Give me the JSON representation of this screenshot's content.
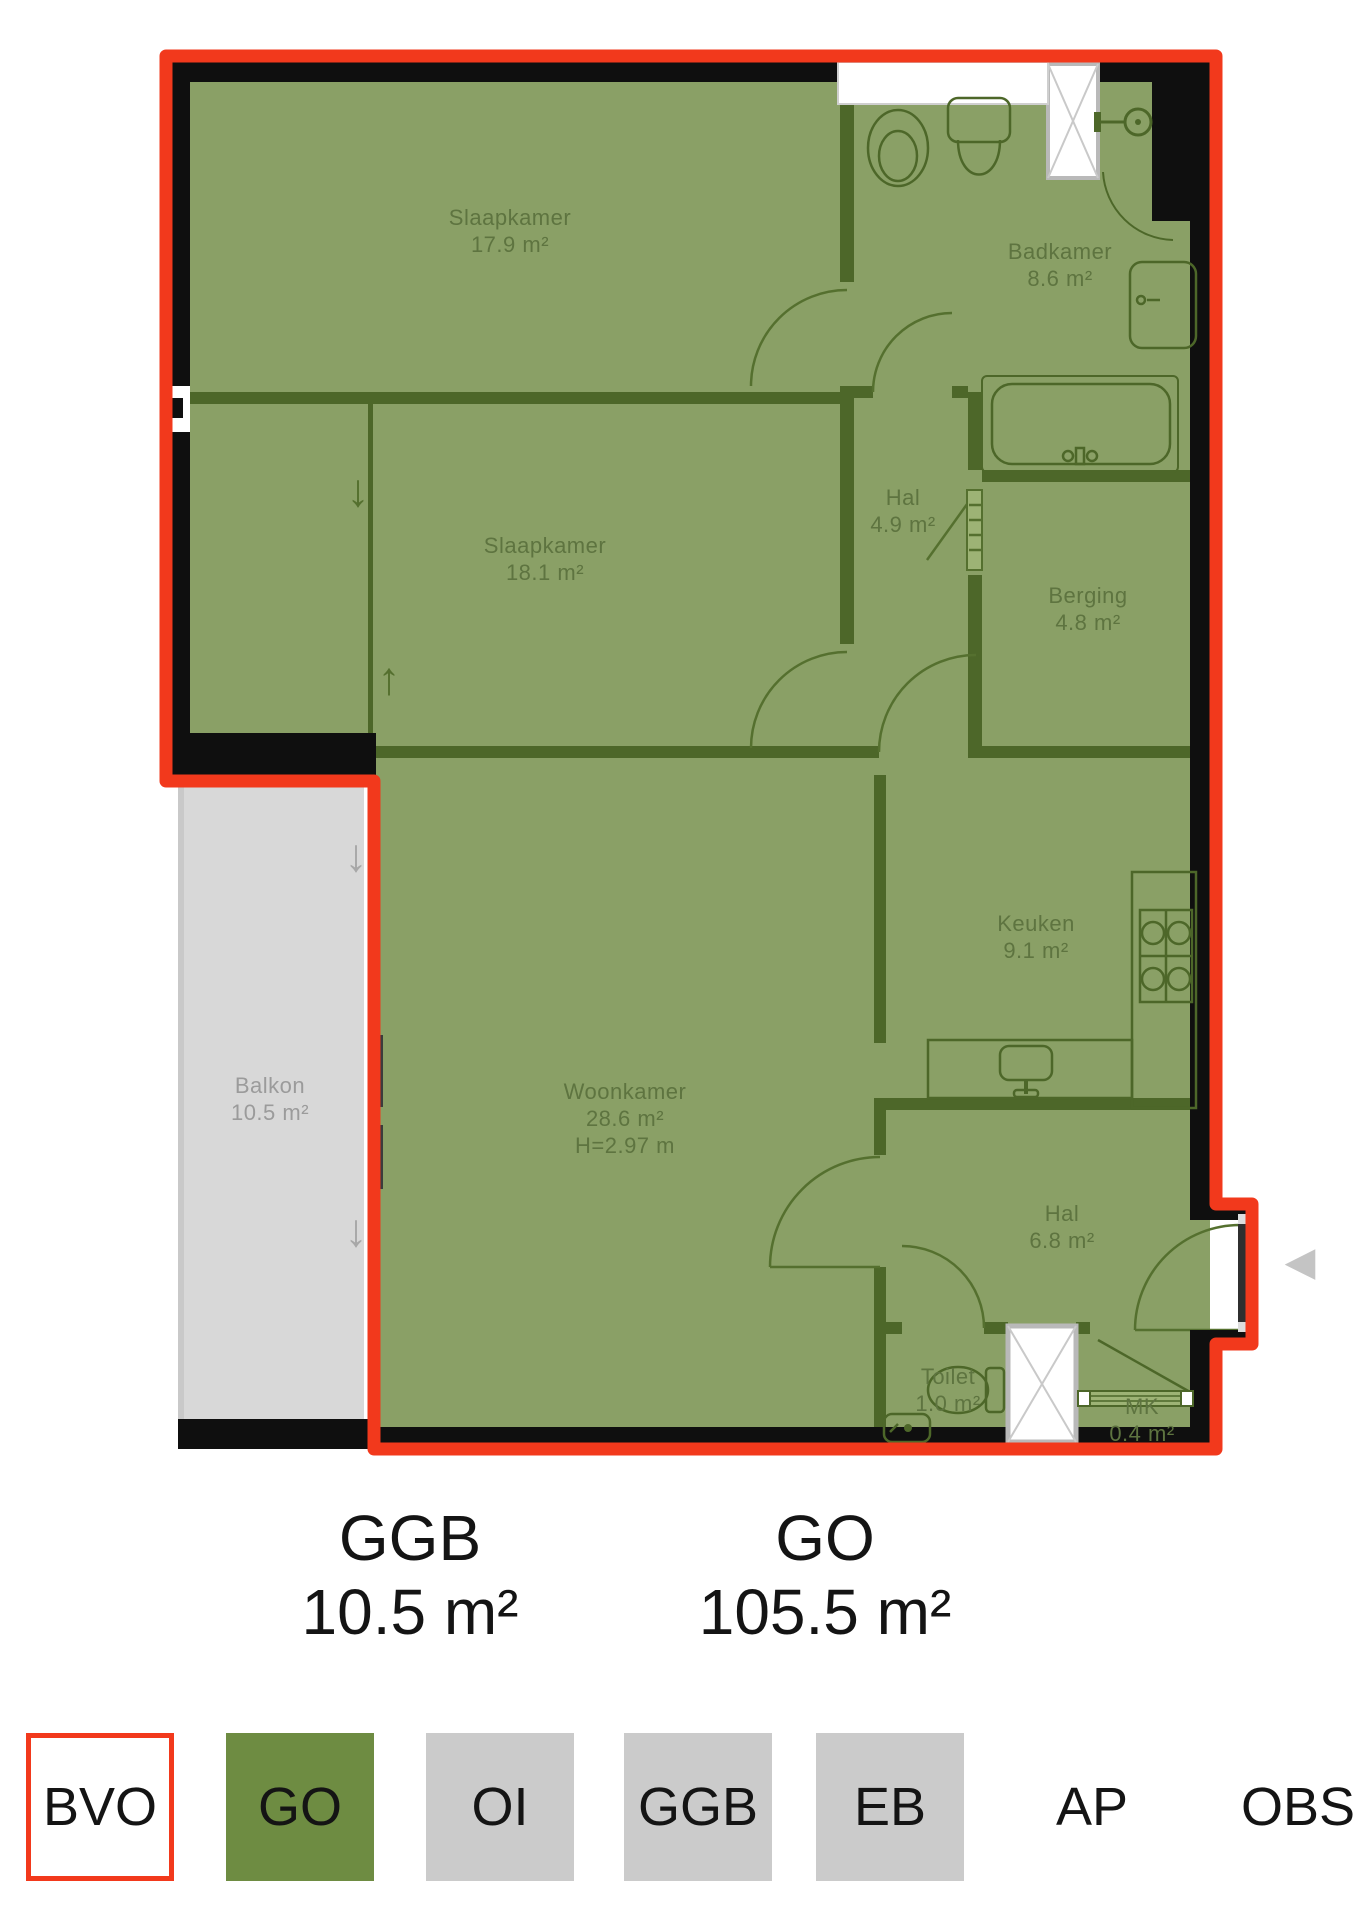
{
  "plan": {
    "rooms": [
      {
        "name": "Slaapkamer",
        "area": "17.9 m²"
      },
      {
        "name": "Badkamer",
        "area": "8.6 m²"
      },
      {
        "name": "Hal",
        "area": "4.9 m²"
      },
      {
        "name": "Slaapkamer",
        "area": "18.1 m²"
      },
      {
        "name": "Berging",
        "area": "4.8 m²"
      },
      {
        "name": "Keuken",
        "area": "9.1 m²"
      },
      {
        "name": "Woonkamer",
        "area": "28.6 m²",
        "height": "H=2.97 m"
      },
      {
        "name": "Balkon",
        "area": "10.5 m²"
      },
      {
        "name": "Hal",
        "area": "6.8 m²"
      },
      {
        "name": "Toilet",
        "area": "1.0 m²"
      },
      {
        "name": "MK",
        "area": "0.4 m²"
      }
    ]
  },
  "summary": {
    "ggb": {
      "label": "GGB",
      "value": "10.5 m²"
    },
    "go": {
      "label": "GO",
      "value": "105.5 m²"
    }
  },
  "legend": [
    {
      "label": "BVO",
      "style": "red-outline-box"
    },
    {
      "label": "GO",
      "style": "green-box"
    },
    {
      "label": "OI",
      "style": "gray-box"
    },
    {
      "label": "GGB",
      "style": "gray-box"
    },
    {
      "label": "EB",
      "style": "gray-box"
    },
    {
      "label": "AP",
      "style": "no-box"
    },
    {
      "label": "OBS",
      "style": "no-box"
    }
  ],
  "icons": {
    "entrance_arrow": "◀",
    "arrow_down": "↓",
    "arrow_up": "↑"
  },
  "colors": {
    "bvo_outline_red": "#f2391c",
    "go_room_green": "#8aa066",
    "go_legend_green": "#6e8c42",
    "partition_green": "#4d6729",
    "exterior_wall_black": "#0f0f0f",
    "balkon_gray": "#d8d8d8",
    "legend_gray": "#cbcbcb",
    "room_label_green": "#5e7440",
    "balkon_label_gray": "#9b9b9b"
  }
}
